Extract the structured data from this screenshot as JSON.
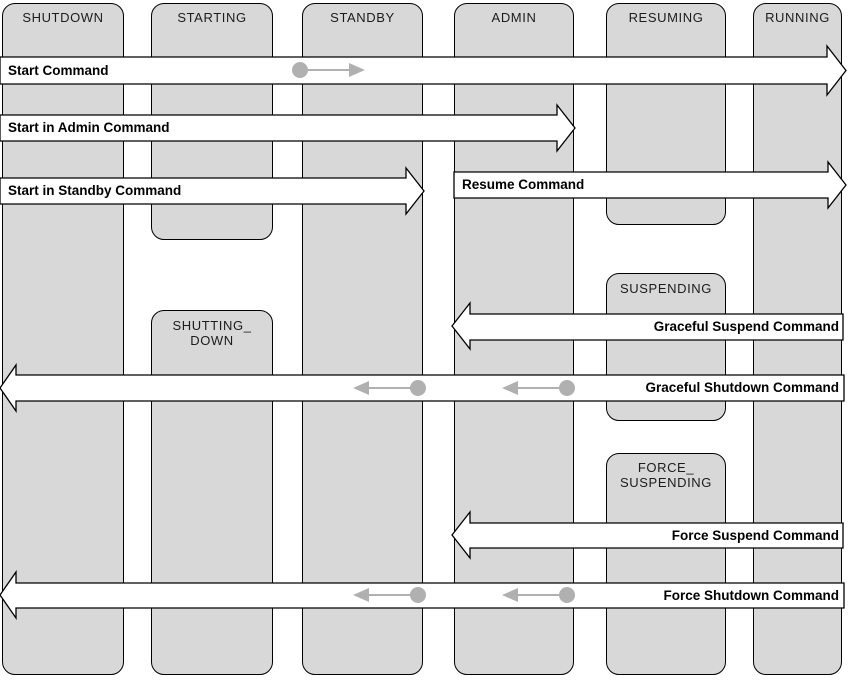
{
  "diagram_title": "Server lifecycle state transition diagram",
  "colors": {
    "state_fill": "#d8d8d8",
    "state_border": "#000000",
    "arrow_fill": "#ffffff",
    "arrow_border": "#000000",
    "marker_gray": "#b0b0b0",
    "label_text": "#1c1c1c",
    "command_text": "#000000"
  },
  "states": [
    {
      "id": "shutdown",
      "label": "SHUTDOWN"
    },
    {
      "id": "starting",
      "label": "STARTING"
    },
    {
      "id": "standby",
      "label": "STANDBY"
    },
    {
      "id": "admin",
      "label": "ADMIN"
    },
    {
      "id": "resuming",
      "label": "RESUMING"
    },
    {
      "id": "running",
      "label": "RUNNING"
    }
  ],
  "transitional_states": [
    {
      "id": "shutting-down",
      "line1": "SHUTTING_",
      "line2": "DOWN"
    },
    {
      "id": "suspending",
      "line1": "SUSPENDING",
      "line2": ""
    },
    {
      "id": "force-suspending",
      "line1": "FORCE_",
      "line2": "SUSPENDING"
    }
  ],
  "commands": [
    {
      "id": "start",
      "label": "Start Command",
      "direction": "right",
      "from": "SHUTDOWN",
      "to": "RUNNING"
    },
    {
      "id": "start-in-admin",
      "label": "Start in Admin Command",
      "direction": "right",
      "from": "SHUTDOWN",
      "to": "ADMIN"
    },
    {
      "id": "start-in-standby",
      "label": "Start in Standby Command",
      "direction": "right",
      "from": "SHUTDOWN",
      "to": "STANDBY"
    },
    {
      "id": "resume",
      "label": "Resume Command",
      "direction": "right",
      "from": "ADMIN",
      "to": "RUNNING"
    },
    {
      "id": "graceful-suspend",
      "label": "Graceful Suspend Command",
      "direction": "left",
      "from": "RUNNING",
      "to": "ADMIN"
    },
    {
      "id": "graceful-shutdown",
      "label": "Graceful Shutdown Command",
      "direction": "left",
      "from": "RUNNING",
      "to": "SHUTDOWN"
    },
    {
      "id": "force-suspend",
      "label": "Force Suspend Command",
      "direction": "left",
      "from": "RUNNING",
      "to": "ADMIN"
    },
    {
      "id": "force-shutdown",
      "label": "Force Shutdown Command",
      "direction": "left",
      "from": "RUNNING",
      "to": "SHUTDOWN"
    }
  ]
}
